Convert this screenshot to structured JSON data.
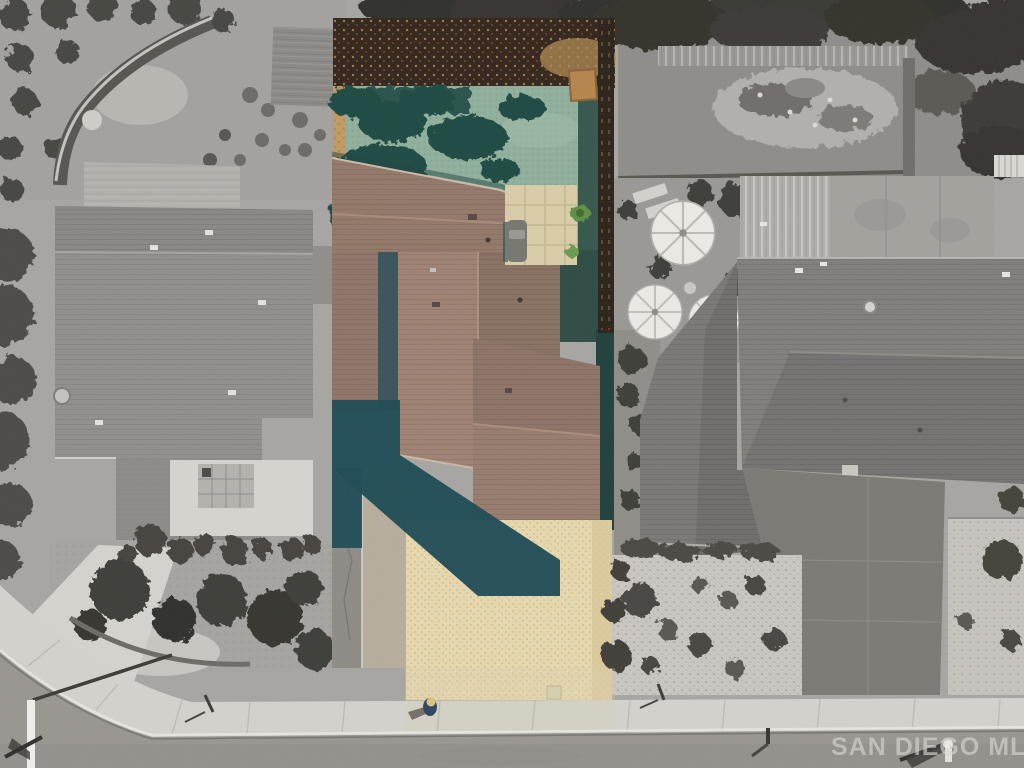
{
  "watermark": {
    "text": "SAN DIEGO MLS"
  },
  "palette": {
    "ground_gray": "#a7a5a1",
    "street": "#98968f",
    "sidewalk": "#d3d2cc",
    "left_roof": "#918f8b",
    "left_roof_flat": "#b3b1ac",
    "right_roof": "#807e7a",
    "right_roof_flat": "#a3a19c",
    "subject_roof": "#937868",
    "turf": "#8faf9b",
    "turf_shadow": "#1f4a42",
    "mulch_dark": "#33241a",
    "mulch_tan": "#c09a62",
    "gravel": "#e7d8ae",
    "house_shadow": "#1d4a55",
    "tree_dark": "#3a3934",
    "driveway_right": "#7b7973",
    "pond_rock": "#b2b0ab",
    "umbrella": "#eceae4"
  }
}
